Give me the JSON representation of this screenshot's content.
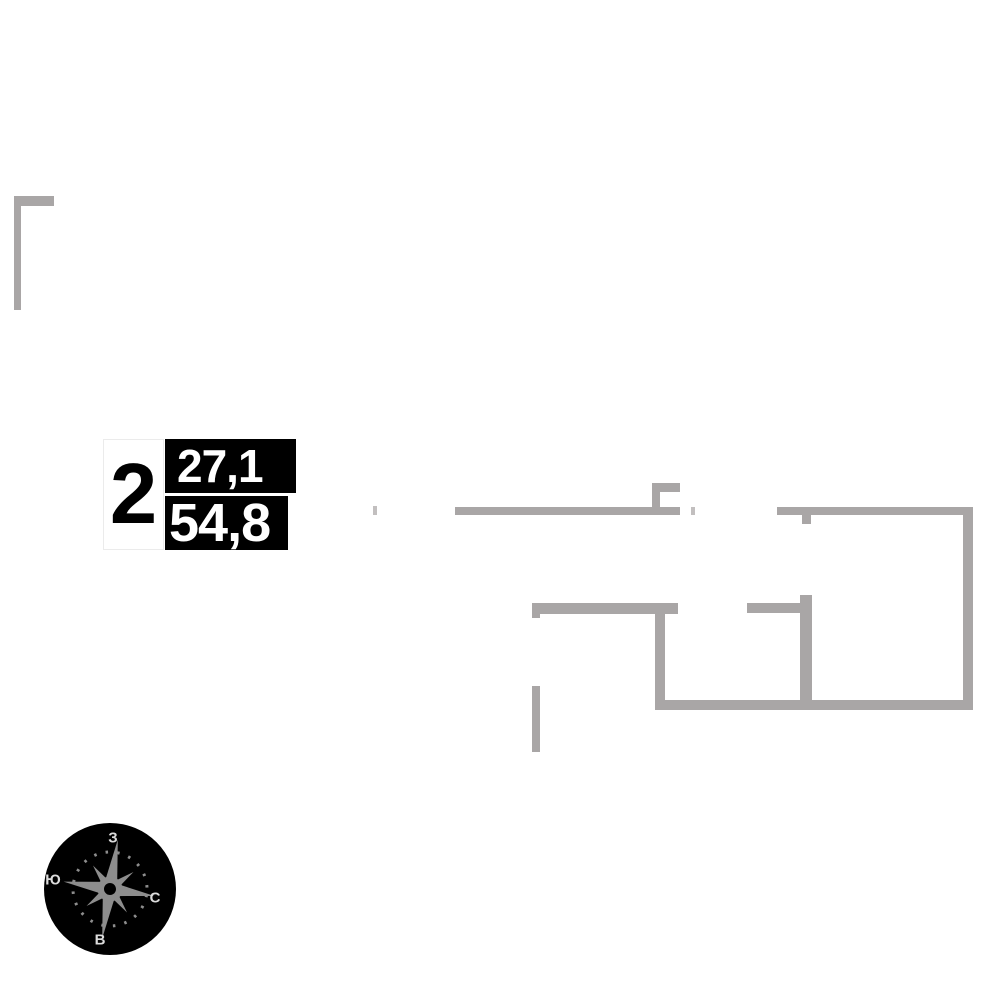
{
  "floorplan": {
    "unit_card": {
      "rooms": "2",
      "living_area": "27,1",
      "total_area": "54,8"
    },
    "compass": {
      "top_letter": "З",
      "left_letter": "Ю",
      "right_letter": "С",
      "bottom_letter": "В"
    },
    "colors": {
      "wall": "#a9a6a6",
      "wall_light": "#c2bfbf",
      "ink": "#000000",
      "paper": "#ffffff",
      "card_border": "#ebebeb",
      "compass_disc": "#000000",
      "compass_star": "#8d8d8d",
      "compass_letters": "#dcdcdc"
    },
    "walls": [
      {
        "name": "entry-wall-horizontal",
        "x": 14,
        "y": 196,
        "w": 40,
        "h": 10
      },
      {
        "name": "entry-wall-vertical",
        "x": 14,
        "y": 196,
        "w": 7,
        "h": 114
      },
      {
        "name": "window-pier-far-left",
        "x": 373,
        "y": 506,
        "w": 4,
        "h": 9,
        "shade": "light"
      },
      {
        "name": "top-wall-main",
        "x": 455,
        "y": 507,
        "w": 225,
        "h": 8
      },
      {
        "name": "top-wall-notch-vertical",
        "x": 652,
        "y": 483,
        "w": 8,
        "h": 24
      },
      {
        "name": "top-wall-notch-horizontal",
        "x": 652,
        "y": 483,
        "w": 28,
        "h": 9
      },
      {
        "name": "window-pier-mid",
        "x": 691,
        "y": 507,
        "w": 4,
        "h": 8,
        "shade": "light"
      },
      {
        "name": "top-wall-right",
        "x": 777,
        "y": 507,
        "w": 196,
        "h": 8
      },
      {
        "name": "door-jamb-tab",
        "x": 802,
        "y": 515,
        "w": 9,
        "h": 9
      },
      {
        "name": "right-wall",
        "x": 963,
        "y": 507,
        "w": 10,
        "h": 203
      },
      {
        "name": "inner-wall-vertical-right",
        "x": 800,
        "y": 595,
        "w": 12,
        "h": 115
      },
      {
        "name": "inner-wall-stub-right",
        "x": 747,
        "y": 603,
        "w": 53,
        "h": 10
      },
      {
        "name": "inner-wall-horizontal-left",
        "x": 532,
        "y": 603,
        "w": 146,
        "h": 11
      },
      {
        "name": "inner-wall-end-lip",
        "x": 532,
        "y": 614,
        "w": 8,
        "h": 4
      },
      {
        "name": "inner-wall-vertical-left",
        "x": 655,
        "y": 612,
        "w": 10,
        "h": 98
      },
      {
        "name": "bottom-wall",
        "x": 655,
        "y": 700,
        "w": 318,
        "h": 10
      },
      {
        "name": "partition-thin",
        "x": 532,
        "y": 686,
        "w": 8,
        "h": 66
      }
    ]
  }
}
